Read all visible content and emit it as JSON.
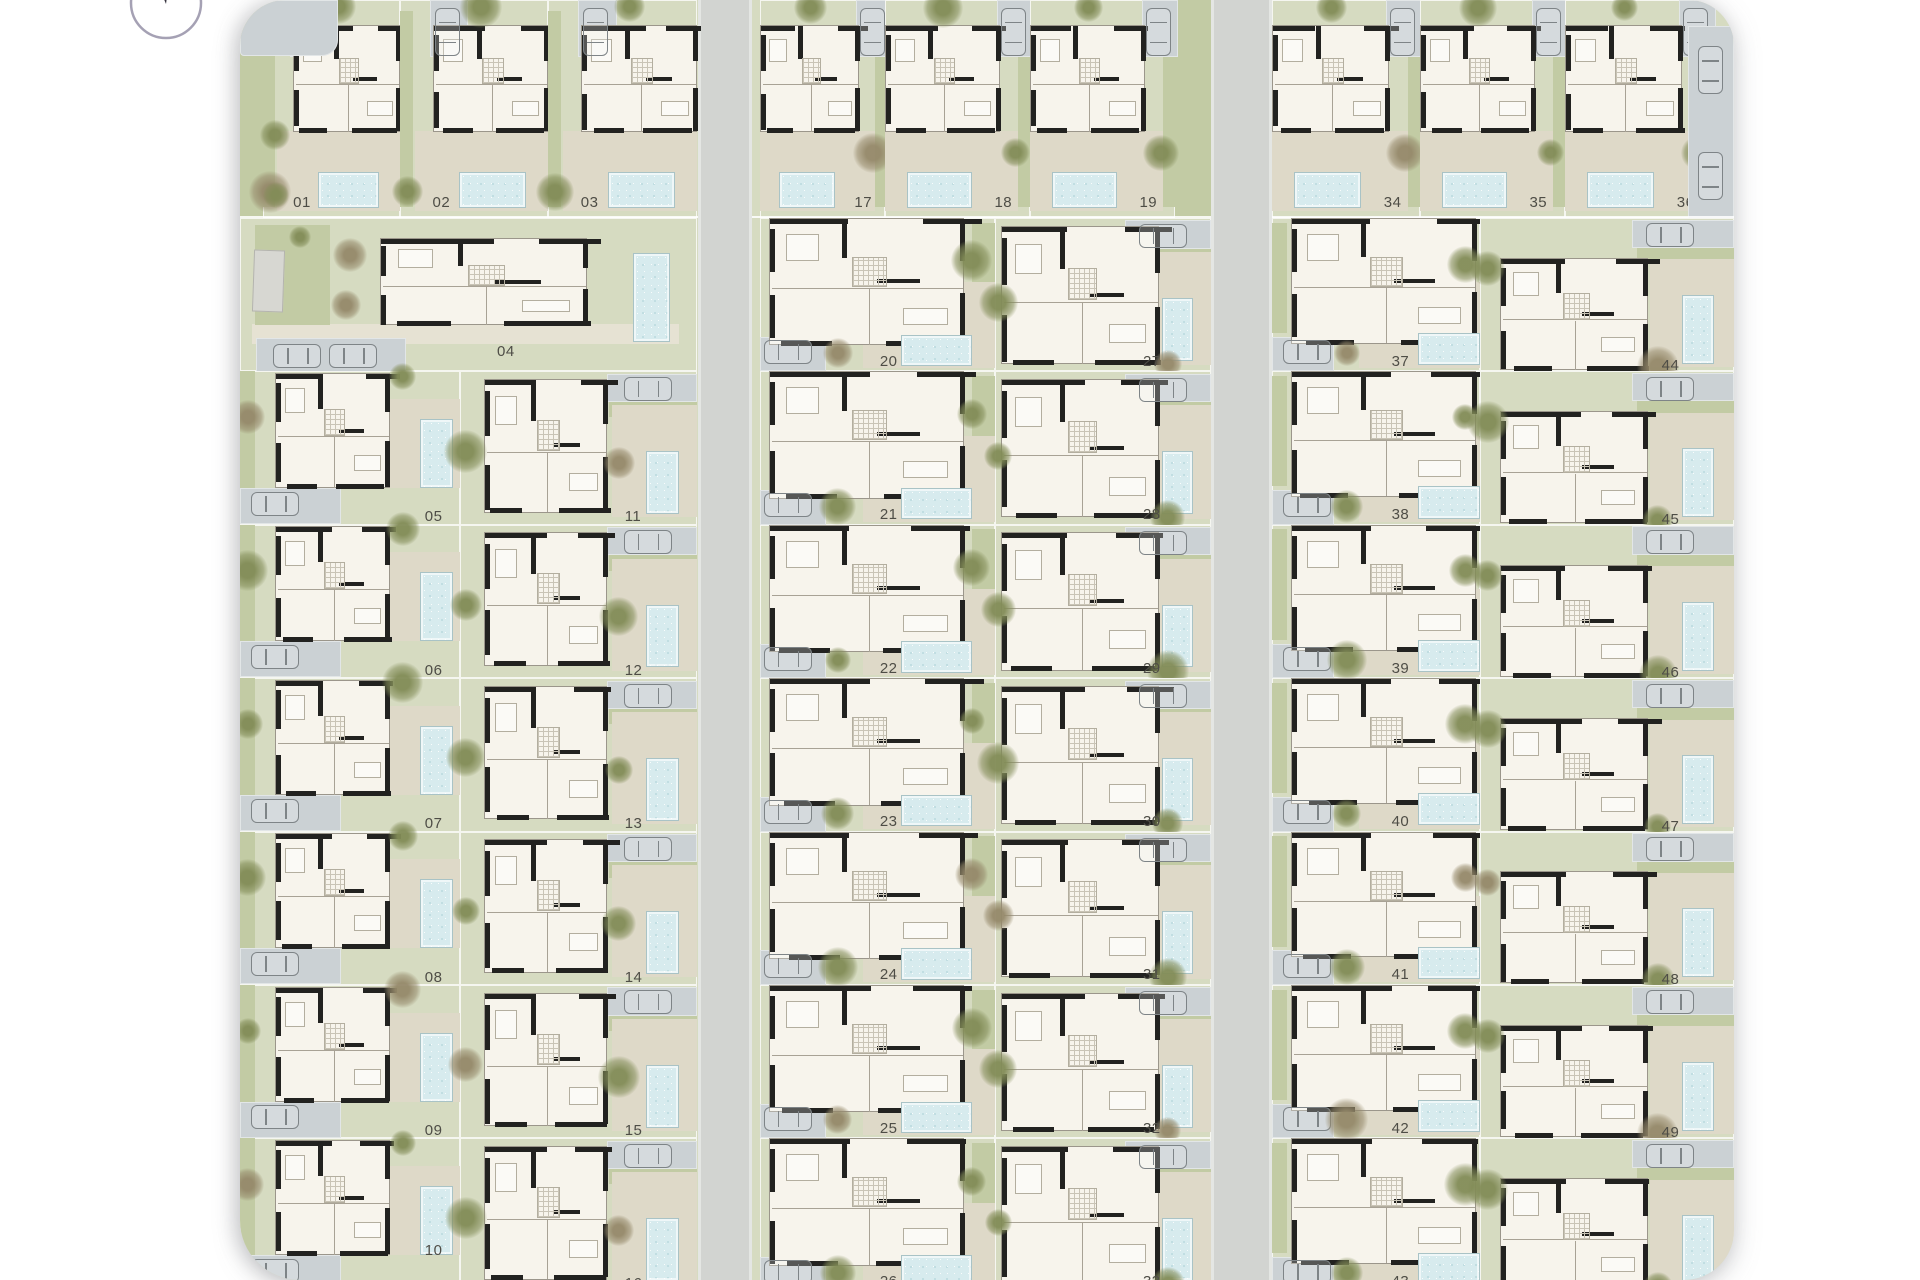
{
  "plan": {
    "kind": "residential-masterplan",
    "blocks": [
      {
        "name": "west",
        "top_row": [
          "01",
          "02",
          "03"
        ],
        "detached_plot": "04",
        "left_column": [
          "05",
          "06",
          "07",
          "08",
          "09",
          "10"
        ],
        "right_column": [
          "11",
          "12",
          "13",
          "14",
          "15",
          "16"
        ]
      },
      {
        "name": "center",
        "top_row": [
          "17",
          "18",
          "19"
        ],
        "left_column": [
          "20",
          "21",
          "22",
          "23",
          "24",
          "25",
          "26"
        ],
        "right_column": [
          "27",
          "28",
          "29",
          "30",
          "31",
          "32",
          "33"
        ]
      },
      {
        "name": "east",
        "top_row": [
          "34",
          "35",
          "36"
        ],
        "left_column": [
          "37",
          "38",
          "39",
          "40",
          "41",
          "42",
          "43"
        ],
        "right_column": [
          "44",
          "45",
          "46",
          "47",
          "48",
          "49",
          "50"
        ]
      }
    ],
    "icons": {
      "compass": "north-arrow"
    },
    "palette": {
      "grass": "#d6dbc1",
      "grass_dark": "#c2cba4",
      "terrace": "#ded9c8",
      "terrace_light": "#e6e2d3",
      "house": "#f7f4ec",
      "wall": "#222220",
      "pool": "#d7ebee",
      "pool_edge": "#a9c3c6",
      "road": "#d2d4d1",
      "sidewalk": "#e4e6e3",
      "driveway": "#cbd1d4",
      "car_outline": "#7e8487",
      "label_text": "#4e4d46",
      "shed": "#d7d7d2",
      "tree_olive": "#828c57",
      "tree_palm": "#95896a",
      "background": "#ffffff"
    }
  }
}
